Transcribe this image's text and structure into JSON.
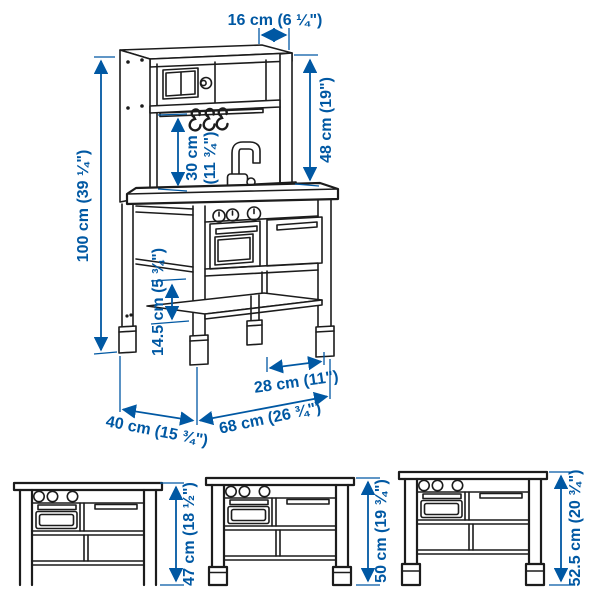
{
  "colors": {
    "accent": "#0058a3",
    "line_art": "#1c1c1c",
    "background": "#ffffff"
  },
  "main_view": {
    "description": "play-kitchen-perspective-line-drawing",
    "dimensions": {
      "top_depth": "16 cm (6 ¼\")",
      "hutch_height": "48 cm (19\")",
      "splashback_height_line1": "30 cm",
      "splashback_height_line2": "(11 ¾\")",
      "total_height": "100 cm (39 ¼\")",
      "shelf_clearance": "14.5 cm (5 ¾\")",
      "leg_spacing": "28 cm (11\")",
      "depth": "40 cm (15 ¾\")",
      "width": "68 cm (26 ¾\")"
    }
  },
  "front_views": [
    {
      "height_label": "47 cm (18 ½\")"
    },
    {
      "height_label": "50 cm (19 ¾\")"
    },
    {
      "height_label": "52.5 cm (20 ¾\")"
    }
  ]
}
